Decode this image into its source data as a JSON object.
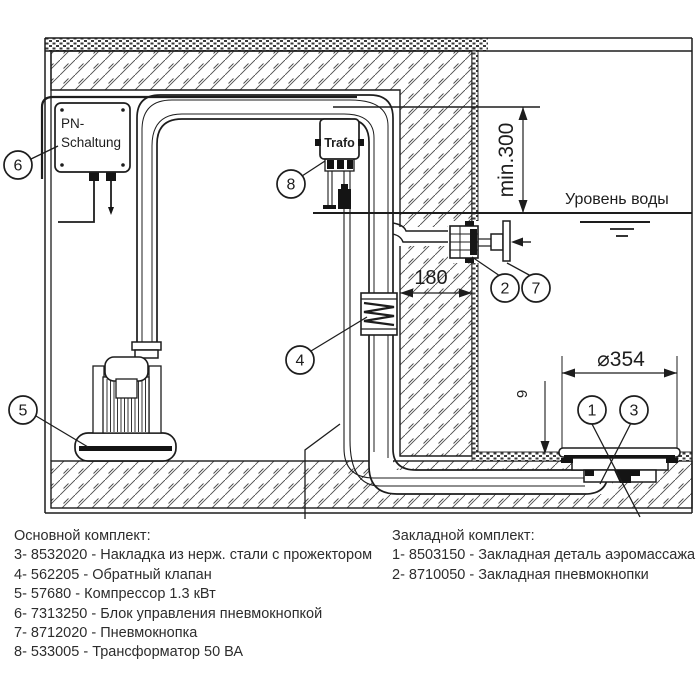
{
  "drawing": {
    "control_box": {
      "line1": "PN-",
      "line2": "Schaltung"
    },
    "transformer_label": "Trafo",
    "water_level_label": "Уровень воды",
    "dimensions": {
      "min_height_above_water": "min.300",
      "wall_thickness": "180",
      "plate_diameter": "⌀354",
      "embed_depth": "9"
    },
    "callouts": {
      "c1": "1",
      "c2": "2",
      "c3": "3",
      "c4": "4",
      "c5": "5",
      "c6": "6",
      "c7": "7",
      "c8": "8"
    }
  },
  "parts_list": {
    "main_kit": {
      "title": "Основной комплект:",
      "items": [
        "3- 8532020 - Накладка из нерж. стали с прожектором",
        "4- 562205 - Обратный клапан",
        "5- 57680 - Компрессор 1.3 кВт",
        "6- 7313250 - Блок управления пневмокнопкой",
        "7- 8712020 - Пневмокнопка",
        "8- 533005 - Трансформатор 50 ВА"
      ]
    },
    "embedded_kit": {
      "title": "Закладной комплект:",
      "items": [
        "1- 8503150 - Закладная деталь аэромассажа",
        "2- 8710050 - Закладная пневмокнопки"
      ]
    }
  },
  "colors": {
    "line": "#1d1d1d",
    "background": "#ffffff"
  }
}
